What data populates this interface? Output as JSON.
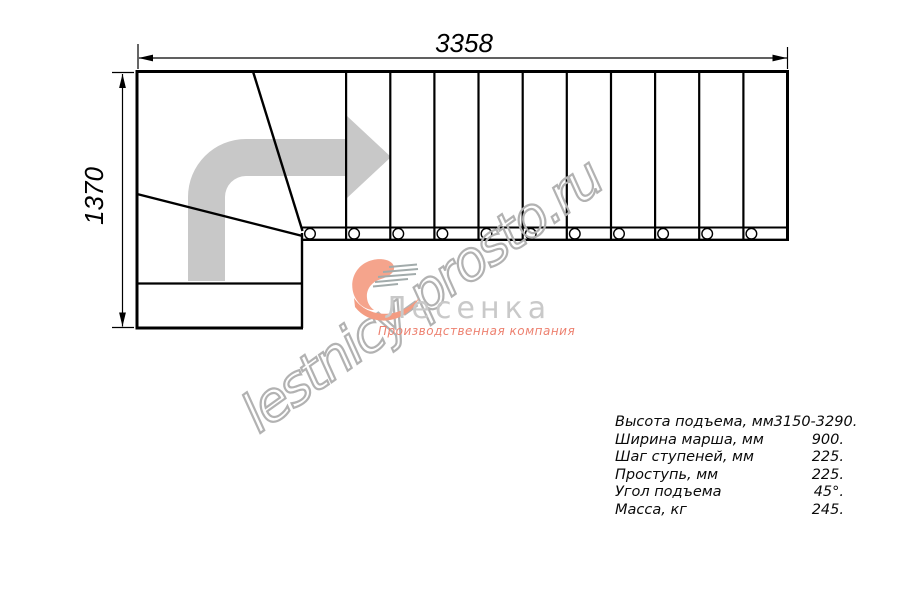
{
  "drawing": {
    "width_label": "3358",
    "height_label": "1370"
  },
  "watermark": {
    "text": "lestnicy-prosto.ru"
  },
  "logo": {
    "brand": "Лесенка",
    "tagline": "Производственная компания",
    "icon": "swoosh-heart-icon"
  },
  "icons": {
    "direction_arrow": "bent-arrow-right-icon"
  },
  "specs": {
    "rows": [
      {
        "label": "Высота подъема, мм",
        "value": "3150-3290."
      },
      {
        "label": "Ширина марша, мм",
        "value": "900."
      },
      {
        "label": "Шаг ступеней, мм",
        "value": "225."
      },
      {
        "label": "Проступь, мм",
        "value": "225."
      },
      {
        "label": "Угол подъема",
        "value": "45°."
      },
      {
        "label": "Масса, кг",
        "value": "245."
      }
    ]
  },
  "colors": {
    "line": "#000000",
    "direction_arrow": "#c8c8c8",
    "watermark_stroke": "#b2b2b2",
    "brand_gray": "#c9c9c9",
    "logo_salmon": "#f5a48c",
    "tagline_salmon": "#ed8170"
  }
}
